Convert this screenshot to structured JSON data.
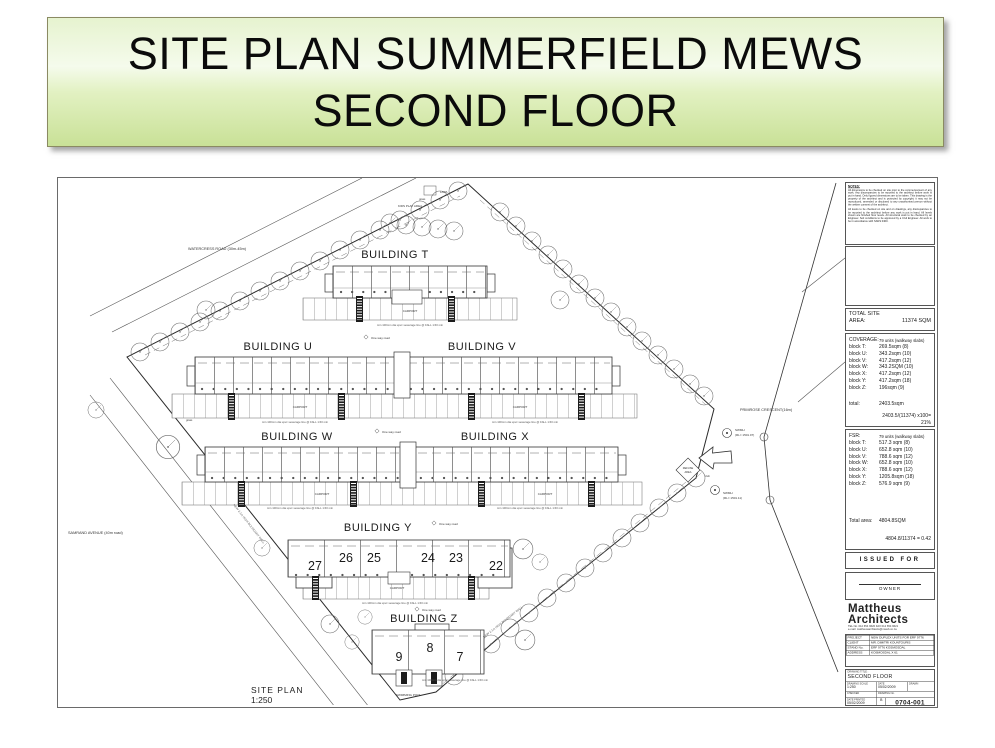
{
  "header": {
    "title_line1": "SITE PLAN SUMMERFIELD MEWS",
    "title_line2": "SECOND FLOOR"
  },
  "plan": {
    "caption": {
      "title": "SITE PLAN",
      "scale": "1:250"
    },
    "roads": {
      "watercress": "WATERCRESS ROAD (30m-45m)",
      "samrand": "SAMRAND AVENUE (40m road)",
      "primrose": "PRIMROSE CRESCENT(16m)"
    },
    "buildings": {
      "t": "BUILDING T",
      "u": "BUILDING U",
      "v": "BUILDING V",
      "w": "BUILDING W",
      "x": "BUILDING X",
      "y": "BUILDING Y",
      "z": "BUILDING Z"
    },
    "y_units": [
      "27",
      "26",
      "25",
      "24",
      "23",
      "22"
    ],
    "z_units": [
      "9",
      "8",
      "7"
    ],
    "annotations": {
      "one_way": "One way road",
      "carport": "CARPORT",
      "swimming_pool": "SWIMMING POOL",
      "refuse_line1": "REFUSE",
      "refuse_line2": "AREA",
      "club": "club",
      "lapa": "LAPA",
      "kids_play": "KIDS PLAY AREA",
      "grass": "grass",
      "swmh": "SWMH",
      "swmh1_rl": "(RL= 1501.07)",
      "swmh2_rl": "(RL= 1501.11)",
      "sewer_note": "min 100mm dia upvc sewerage line @ FALL 1:60 min",
      "boundary_note": "NEW 2.1m HIGH BOUNDARY WALL"
    }
  },
  "titleblock": {
    "notes": {
      "heading": "NOTES:",
      "para1": "All dimensions to be checked on site prior to the commencement of any work. Any discrepancies to be reported to the architect before work is put in hand. Only figured dimensions are to be taken. This drawing is the property of the architect and is protected by copyright; it may not be reproduced, amended or disclosed to any unauthorised person without the written consent of the architect.",
      "para2": "All levels to be checked on site and on drawings, any discrepancies to be reported to the architect before any work is put in hand. All levels shown are finished floor levels. All structural work to be checked by an Engineer. Soil conditions to be approved by a Civil Engineer. All work to be in accordance with SANS 0400."
    },
    "total_site": {
      "label_line1": "TOTAL SITE",
      "label_line2": "AREA:",
      "value": "11374 SQM"
    },
    "coverage": {
      "label": "COVERAGE:",
      "units": "79 units (walkway slabs)",
      "rows": [
        {
          "l": "block T:",
          "v": "269.5sqm  (8)"
        },
        {
          "l": "block U:",
          "v": "343.2sqm  (10)"
        },
        {
          "l": "block V:",
          "v": "417.2sqm  (12)"
        },
        {
          "l": "block W:",
          "v": "343.2SQM  (10)"
        },
        {
          "l": "block X:",
          "v": "417.2sqm  (12)"
        },
        {
          "l": "block Y:",
          "v": "417.2sqm  (18)"
        },
        {
          "l": "block Z:",
          "v": "196sqm  (9)"
        }
      ],
      "total_label": "total:",
      "total_value": "2403.5sqm",
      "calc_line1": "2403.5/(11374) x100=",
      "calc_line2": "21%"
    },
    "fsr": {
      "label": "FSR:",
      "units": "79 units (walkway slabs)",
      "rows": [
        {
          "l": "block T:",
          "v": "517.3 sqm  (8)"
        },
        {
          "l": "block U:",
          "v": "652.8 sqm  (10)"
        },
        {
          "l": "block V:",
          "v": "788.6 sqm  (12)"
        },
        {
          "l": "block W:",
          "v": "652.8 sqm  (10)"
        },
        {
          "l": "block X:",
          "v": "788.6 sqm  (12)"
        },
        {
          "l": "block Y:",
          "v": "1205.8sqm  (18)"
        },
        {
          "l": "block Z:",
          "v": "576.9 sqm  (9)"
        }
      ],
      "total_label": "Total area:",
      "total_value": "4804.8SQM",
      "calc": "4804.8/11374 = 0.42"
    },
    "issued": "ISSUED FOR CLIENT",
    "owner": "OWNER",
    "firm": {
      "name_line1": "Mattheus",
      "name_line2": "Architects",
      "contact_line1": "TEL No. 012 654 9620    FAX 012 654 9621",
      "contact_line2": "e-mail: mattheusarchitects@mweb.co.za"
    },
    "project": {
      "rows": [
        {
          "l": "PROJECT",
          "v": "NEW DUPLEX UNITS FOR ERF 9776"
        },
        {
          "l": "CLIENT",
          "v": "MR. DIMITRI KOUNTOURIS"
        },
        {
          "l": "STAND No.",
          "v": "ERF 9776 KOSMOSDAL"
        },
        {
          "l": "ADDRESS",
          "v": "KOSMOSDAL X 61"
        }
      ]
    },
    "drawing": {
      "title_label": "DRAWING TITLE :",
      "title": "SECOND FLOOR",
      "scale_label": "DRAWING SCALE",
      "scale": "1:250",
      "date_label": "DATE",
      "date": "05/02/2009",
      "drawn_label": "DRAWN",
      "checked_label": "CHECKED",
      "no_label": "DRAWING No.",
      "printed_label": "DATE PRINTED",
      "printed": "05/02/2009",
      "rev": "B",
      "number": "0704-001"
    }
  }
}
